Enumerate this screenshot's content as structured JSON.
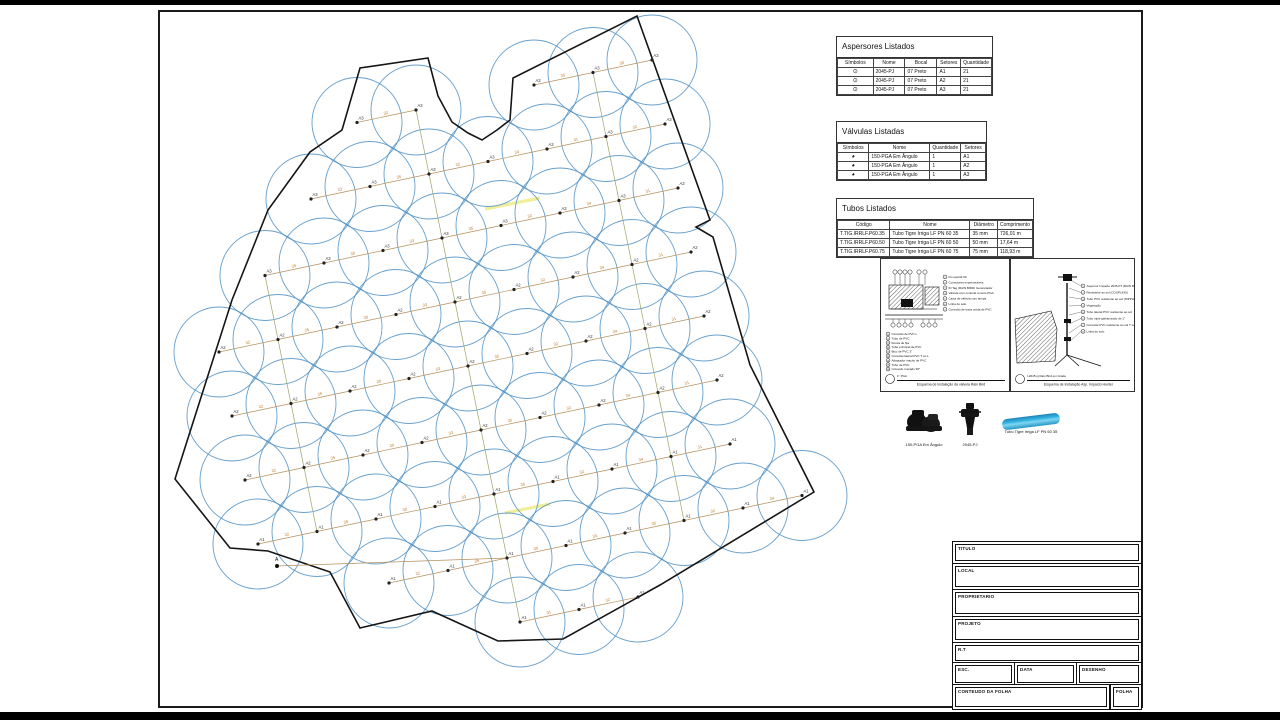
{
  "tables": {
    "aspersores": {
      "title": "Aspersores Listados",
      "columns": [
        "Símbolos",
        "Nome",
        "Bocal",
        "Setores",
        "Quantidade"
      ],
      "rows": [
        [
          "⊙",
          "2045-PJ",
          "07 Preto",
          "A1",
          "21"
        ],
        [
          "⊙",
          "2045-PJ",
          "07 Preto",
          "A2",
          "21"
        ],
        [
          "⊙",
          "2045-PJ",
          "07 Preto",
          "A3",
          "21"
        ]
      ]
    },
    "valvulas": {
      "title": "Válvulas Listadas",
      "columns": [
        "Símbolos",
        "Nome",
        "Quantidade",
        "Setores"
      ],
      "rows": [
        [
          "◕",
          "150-PGA Em Ângulo",
          "1",
          "A1"
        ],
        [
          "◕",
          "150-PGA Em Ângulo",
          "1",
          "A2"
        ],
        [
          "◕",
          "150-PGA Em Ângulo",
          "1",
          "A3"
        ]
      ]
    },
    "tubos": {
      "title": "Tubos Listados",
      "columns": [
        "Código",
        "Nome",
        "Diâmetro",
        "Comprimento"
      ],
      "rows": [
        [
          "T.TIG.IRRLF.P60.35",
          "Tubo Tigre Irriga LF PN 60 35",
          "35 mm",
          "726,01 m"
        ],
        [
          "T.TIG.IRRLF.P60.50",
          "Tubo Tigre Irriga LF PN 60 50",
          "50 mm",
          "17,64 m"
        ],
        [
          "T.TIG.IRRLF.P60.75",
          "Tubo Tigre Irriga LF PN 60 75",
          "75 mm",
          "118,93 m"
        ]
      ]
    }
  },
  "details": {
    "valvula": {
      "badge": "1\" PGA",
      "caption": "Esquema de instalação da válvula Rain Bird",
      "callouts_direita": [
        "Fio espiral 30",
        "Conectores impermeáveis",
        "ID Tag (RAIN BIRD) Gerenciador",
        "Válvula com controle remoto PGA",
        "Caixa de válvula com tampa",
        "Linha do solo",
        "Conexão de trava unida de PVC"
      ],
      "callouts_baixo": [
        "Conexão de PVC L",
        "Tubo de PVC",
        "Rosca de fita",
        "Tubo principal de PVC",
        "Bico de PVC 3\"",
        "Conexão lateral PVC T ou L",
        "Adaptador macho de PVC",
        "Tubo de PVC",
        "Cotovelo roscado 90°"
      ]
    },
    "aspersor": {
      "badge": "I-2045 pj Rain Bird em Grade",
      "caption": "Esquema de instalação Asp. Impacto Hunter",
      "callouts": [
        "Aspersor Impacto 2045-PJ (RAIN BIRD)",
        "Resistente ao sol (COUPLING)",
        "Tubo PVC resistente ao sol (NIPPLE)",
        "Vegetação",
        "Tubo lateral PVC resistente ao sol",
        "Tubo niple galvanizado de 1\"",
        "Conexão PVC resistente ao sol T ou L (SCH 40)",
        "Linha do solo"
      ]
    }
  },
  "legend": {
    "items": [
      {
        "icon": "valve-photo",
        "label": "150-PGA Em Ângulo"
      },
      {
        "icon": "sprinkler-photo",
        "label": "2045-PJ"
      },
      {
        "icon": "pipe-photo",
        "label": "Tubo Tigre Irriga LF PN 60 35"
      }
    ]
  },
  "titleblock": {
    "titulo": "TITULO",
    "local": "LOCAL",
    "proprietario": "PROPRIETARIO",
    "projeto": "PROJETO",
    "rt": "R.T",
    "esc": "ESC.",
    "data": "DATA",
    "desenho": "DESENHO",
    "conteudo": "CONTEUDO DA FOLHA",
    "folha": "FOLHA"
  },
  "plan": {
    "boundary": [
      [
        637,
        16
      ],
      [
        710,
        220
      ],
      [
        696,
        227
      ],
      [
        713,
        237
      ],
      [
        750,
        365
      ],
      [
        814,
        492
      ],
      [
        660,
        585
      ],
      [
        563,
        639
      ],
      [
        498,
        641
      ],
      [
        432,
        611
      ],
      [
        360,
        628
      ],
      [
        330,
        572
      ],
      [
        268,
        551
      ],
      [
        230,
        548
      ],
      [
        175,
        479
      ],
      [
        232,
        300
      ],
      [
        268,
        210
      ],
      [
        310,
        152
      ],
      [
        342,
        130
      ],
      [
        360,
        68
      ],
      [
        428,
        58
      ],
      [
        438,
        96
      ],
      [
        452,
        122
      ],
      [
        468,
        133
      ],
      [
        482,
        140
      ],
      [
        497,
        130
      ],
      [
        510,
        120
      ],
      [
        513,
        78
      ]
    ],
    "grid": {
      "origin": [
        180,
        160
      ],
      "u": [
        59,
        -12.5
      ],
      "v": [
        13,
        64
      ],
      "cols": 10,
      "rows": 9
    },
    "circle_radius": 45,
    "sector_by_row": [
      "A3",
      "A3",
      "A3",
      "A2",
      "A2",
      "A2",
      "A1",
      "A1",
      "A1"
    ],
    "pipe_lengths": [
      "32",
      "35",
      "30",
      "33",
      "35",
      "32",
      "34",
      "31"
    ],
    "connector_cols": [
      1,
      4,
      7
    ],
    "highlights": [
      [
        485,
        209,
        540,
        198
      ],
      [
        505,
        513,
        550,
        504
      ]
    ],
    "source": {
      "label": "A",
      "x": 277,
      "y": 566,
      "to": [
        507,
        558
      ]
    },
    "colors": {
      "circle": "#4e8fc4",
      "boundary": "#151515",
      "pipe": "#b5915f",
      "connector": "#9aa86b",
      "label": "#333333",
      "length": "#c07a28",
      "highlight": "#f0ee9a"
    }
  }
}
